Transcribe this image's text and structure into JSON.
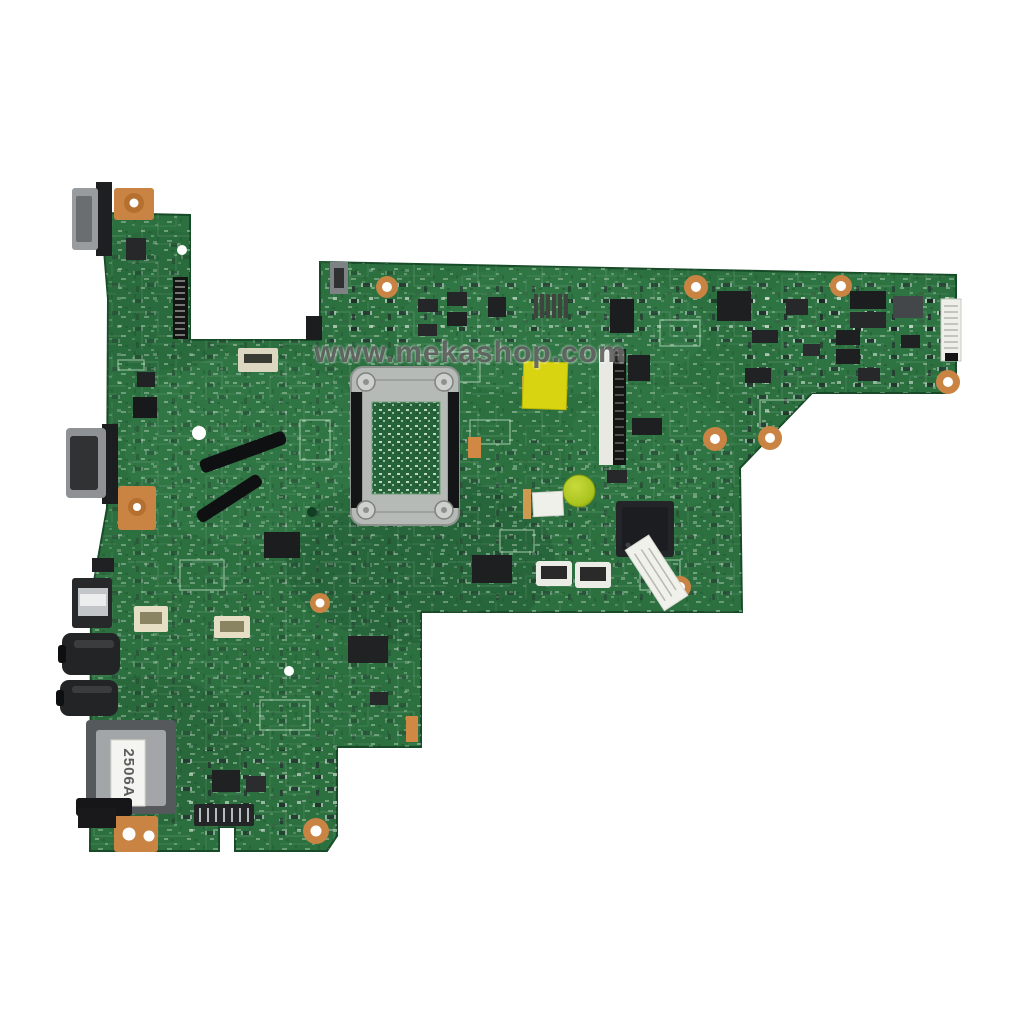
{
  "scene": {
    "type": "product-photo",
    "subject": "green laptop motherboard, top view, on white background",
    "background": "#ffffff"
  },
  "watermark": {
    "text": "www.mekashop.com",
    "color": "#4e4e4e"
  },
  "stickers": {
    "sd_label": "2506A"
  },
  "colors": {
    "pcb_green": "#2c7040",
    "pcb_dark": "#1c4f2c",
    "pcb_light": "#3e8a50",
    "silkscreen": "#d6ecd6",
    "copper_pad": "#c98443",
    "socket_metal": "#b6bab6",
    "yellow_sticker": "#d9d411",
    "green_dot_sticker": "#a9c41e",
    "connector_cream": "#e6dfc6",
    "connector_white": "#ecece6",
    "chip_black": "#1d1f21"
  },
  "parts": [
    "vga-port",
    "mounting-bracket-top",
    "display-cable-connector",
    "vga-port-2",
    "mounting-bracket-mid",
    "usb-port",
    "audio-jack-1",
    "audio-jack-2",
    "speaker-connector",
    "fan-connector",
    "sd-card-slot",
    "sd-eject-lever",
    "edge-connector",
    "pin-header",
    "mounting-bracket-bottom",
    "cpu-socket-bracket",
    "thermal-pad-1",
    "thermal-pad-2",
    "lvds-connector",
    "yellow-sticker",
    "qc-green-dot-sticker",
    "white-sticker",
    "southbridge-chip",
    "serial-label-sticker",
    "ffc-connector",
    "power-circuitry",
    "ribbon-connector-right",
    "mounting-holes"
  ]
}
